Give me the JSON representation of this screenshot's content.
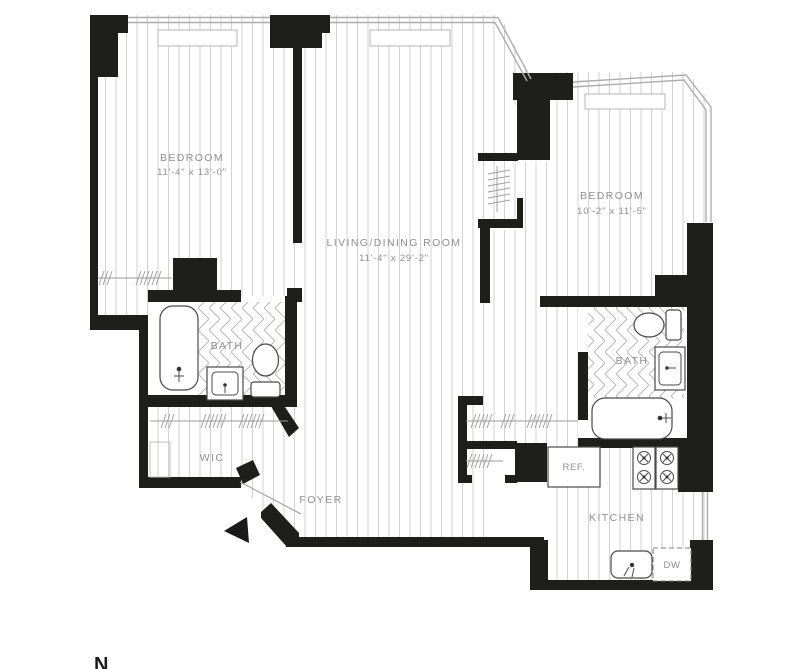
{
  "colors": {
    "wall": "#1e1e1c",
    "floor_line": "#d2d2d2",
    "tile_line": "#b9b9b9",
    "fixture": "#4a4a4a",
    "window": "#adadad",
    "label": "#8f8f8f"
  },
  "rooms": {
    "bedroom_left": {
      "label": "BEDROOM",
      "dimensions": "11'-4\" x 13'-0\""
    },
    "living_dining": {
      "label": "LIVING/DINING ROOM",
      "dimensions": "11'-4\" x 29'-2\""
    },
    "bedroom_right": {
      "label": "BEDROOM",
      "dimensions": "10'-2\" x 11'-5\""
    },
    "bath_left": {
      "label": "BATH"
    },
    "bath_right": {
      "label": "BATH"
    },
    "wic": {
      "label": "WIC"
    },
    "foyer": {
      "label": "FOYER"
    },
    "kitchen": {
      "label": "KITCHEN"
    }
  },
  "appliances": {
    "refrigerator": "REF.",
    "dishwasher": "DW"
  },
  "compass": {
    "north": "N"
  }
}
